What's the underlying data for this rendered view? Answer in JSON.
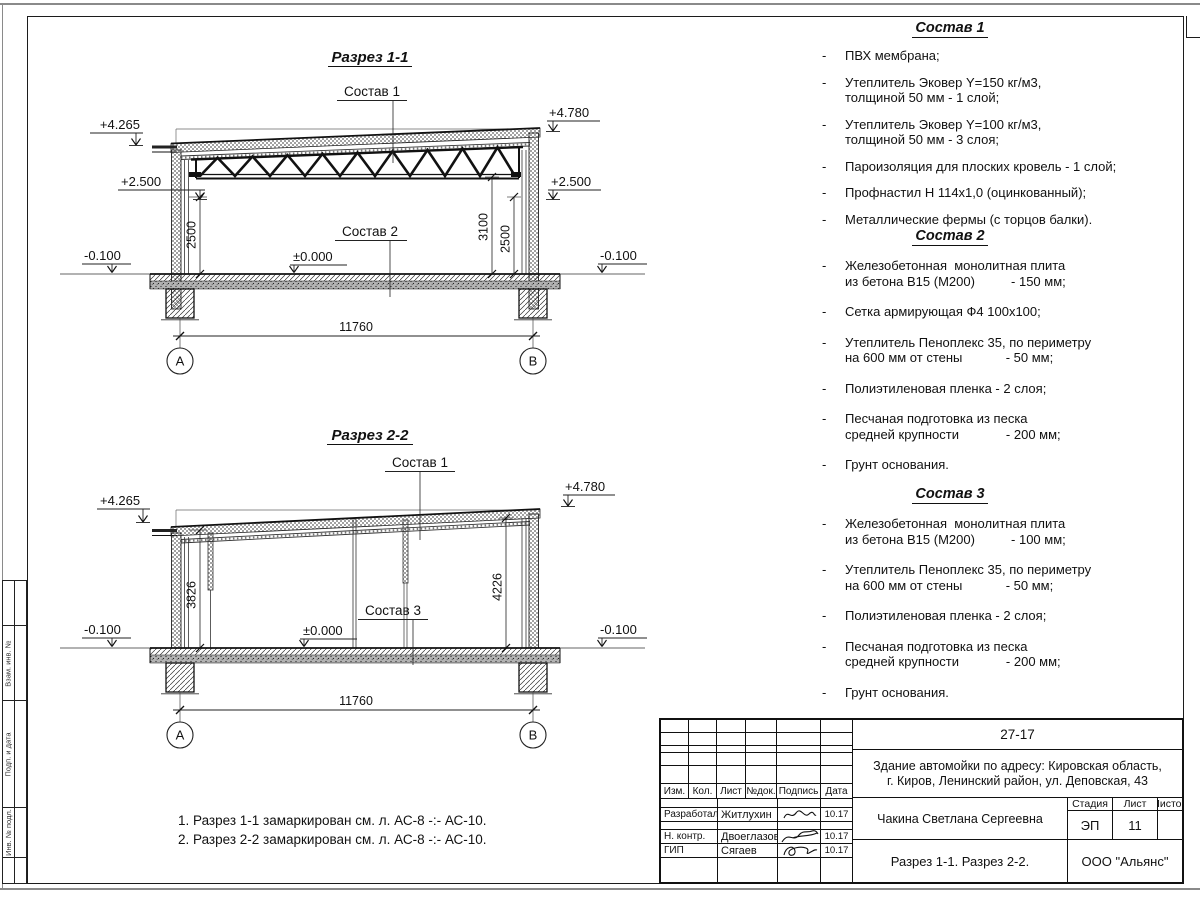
{
  "misc": {
    "dash": "-"
  },
  "side_strip": {
    "cells": [
      "Взам. инв. №",
      "Подп. и дата",
      "Инв. № подл."
    ]
  },
  "section1": {
    "title": "Разрез 1-1",
    "callout_top": "Состав 1",
    "callout_floor": "Состав 2",
    "elev_left_top": "+4.265",
    "elev_right_top": "+4.780",
    "elev_left_mid": "+2.500",
    "elev_right_mid": "+2.500",
    "elev_zero": "±0.000",
    "elev_left_ground": "-0.100",
    "elev_right_ground": "-0.100",
    "dim_left_height": "2500",
    "dim_right_height1": "3100",
    "dim_right_height2": "2500",
    "dim_span": "11760",
    "axis_left": "А",
    "axis_right": "В"
  },
  "section2": {
    "title": "Разрез 2-2",
    "callout_top": "Состав 1",
    "callout_floor": "Состав 3",
    "elev_left_top": "+4.265",
    "elev_right_top": "+4.780",
    "elev_zero": "±0.000",
    "elev_left_ground": "-0.100",
    "elev_right_ground": "-0.100",
    "dim_left_height": "3826",
    "dim_right_height": "4226",
    "dim_span": "11760",
    "axis_left": "А",
    "axis_right": "В"
  },
  "comps": [
    {
      "title": "Состав 1",
      "items": [
        [
          "ПВХ мембрана;"
        ],
        [
          "Утеплитель Эковер Y=150 кг/м3,",
          "толщиной 50 мм - 1 слой;"
        ],
        [
          "Утеплитель Эковер Y=100 кг/м3,",
          "толщиной 50 мм - 3 слоя;"
        ],
        [
          "Пароизоляция для плоских кровель - 1 слой;"
        ],
        [
          "Профнастил Н 114х1,0 (оцинкованный);"
        ],
        [
          "Металлические фермы (с торцов балки)."
        ]
      ]
    },
    {
      "title": "Состав 2",
      "items": [
        [
          "Железобетонная  монолитная плита",
          "из бетона В15 (М200)          - 150 мм;"
        ],
        [
          "Сетка армирующая Ф4 100х100;"
        ],
        [
          "Утеплитель Пеноплекс 35, по периметру",
          "на 600 мм от стены            - 50 мм;"
        ],
        [
          "Полиэтиленовая пленка - 2 слоя;"
        ],
        [
          "Песчаная подготовка из песка",
          "средней крупности             - 200 мм;"
        ],
        [
          "Грунт основания."
        ]
      ]
    },
    {
      "title": "Состав 3",
      "items": [
        [
          "Железобетонная  монолитная плита",
          "из бетона В15 (М200)          - 100 мм;"
        ],
        [
          "Утеплитель Пеноплекс 35, по периметру",
          "на 600 мм от стены            - 50 мм;"
        ],
        [
          "Полиэтиленовая пленка - 2 слоя;"
        ],
        [
          "Песчаная подготовка из песка",
          "средней крупности             - 200 мм;"
        ],
        [
          "Грунт основания."
        ]
      ]
    }
  ],
  "notes": {
    "n1": "1. Разрез 1-1 замаркирован см. л. АС-8 -:- АС-10.",
    "n2": "2. Разрез 2-2 замаркирован см. л. АС-8 -:- АС-10."
  },
  "titleblock": {
    "doc_code": "27-17",
    "project1": "Здание автомойки по адресу: Кировская область,",
    "project2": "г. Киров, Ленинский район, ул. Деповская, 43",
    "cols": {
      "izm": "Изм.",
      "kol": "Кол.",
      "list": "Лист",
      "ndok": "№док.",
      "podpis": "Подпись",
      "data": "Дата"
    },
    "rows": {
      "r1_role": "Разработал",
      "r1_name": "Житлухин",
      "r1_date": "10.17",
      "r2_role": "Н. контр.",
      "r2_name": "Двоеглазов",
      "r2_date": "10.17",
      "r3_role": "ГИП",
      "r3_name": "Сягаев",
      "r3_date": "10.17"
    },
    "author": "Чакина Светлана Сергеевна",
    "stage_label": "Стадия",
    "sheet_label": "Лист",
    "sheets_label": "Листов",
    "stage": "ЭП",
    "sheet_no": "11",
    "sheets_total": "",
    "sheet_title": "Разрез 1-1. Разрез 2-2.",
    "company": "ООО \"Альянс\""
  }
}
